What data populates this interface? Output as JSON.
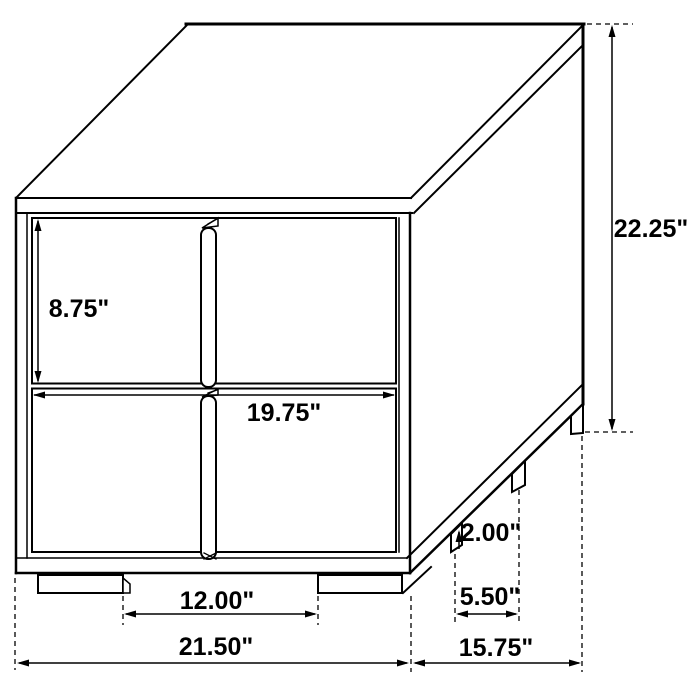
{
  "drawing": {
    "subject": "two-drawer nightstand dimension diagram",
    "line_color": "#000000",
    "background_color": "#ffffff",
    "dims": {
      "overall_height": {
        "label": "22.25\""
      },
      "drawer_height": {
        "label": "8.75\""
      },
      "drawer_width": {
        "label": "19.75\""
      },
      "front_feet_gap": {
        "label": "12.00\""
      },
      "overall_width": {
        "label": "21.50\""
      },
      "foot_height": {
        "label": "2.00\""
      },
      "side_feet_gap": {
        "label": "5.50\""
      },
      "overall_depth": {
        "label": "15.75\""
      }
    }
  }
}
